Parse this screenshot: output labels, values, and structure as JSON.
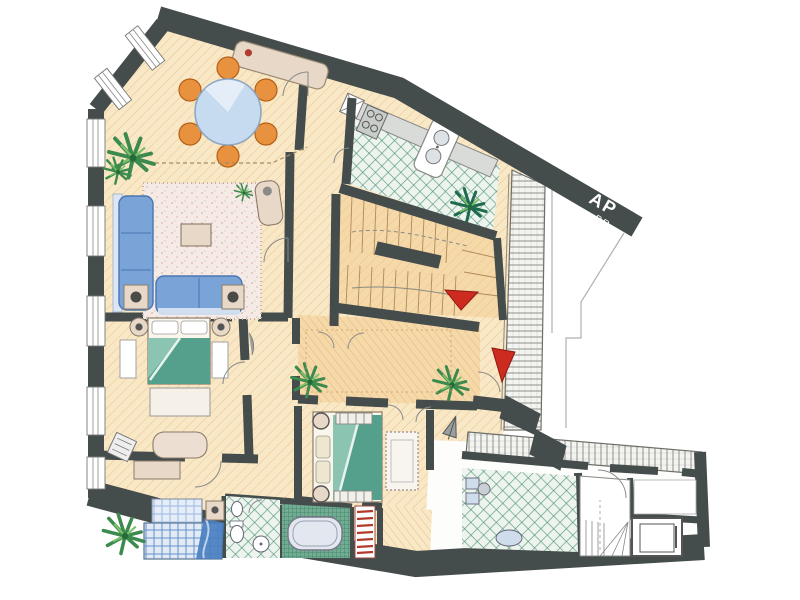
{
  "banner": {
    "line1": "AP",
    "line2": "PR"
  },
  "colors": {
    "wall": "#454c4c",
    "parquet": "#f9e8c5",
    "parquet_line": "#dfa269",
    "parquet_deep": "#f5d9a8",
    "tile_green_line": "#3f8a6a",
    "tile_green_bg": "#edf4ee",
    "tile_dense_bg": "#74ac93",
    "tile_dense_line": "#2e7a5e",
    "gallery_bg": "#f4f4f1",
    "gallery_line": "#8f8f8a",
    "sofa_blue": "#7aa3d8",
    "sofa_blue_dark": "#4a75b0",
    "chair_orange": "#e8913e",
    "table_glass": "#c6daf0",
    "blanket_teal": "#55a08c",
    "bed_plaid": "#5b8cc8",
    "furniture_beige": "#e7d8c8",
    "rug_pink": "#f5eae5",
    "plant_green": "#3c8a4e",
    "accent_red": "#cd2a20",
    "counter_gray": "#d8dbd7",
    "fixture_blue": "#cfdcec"
  }
}
